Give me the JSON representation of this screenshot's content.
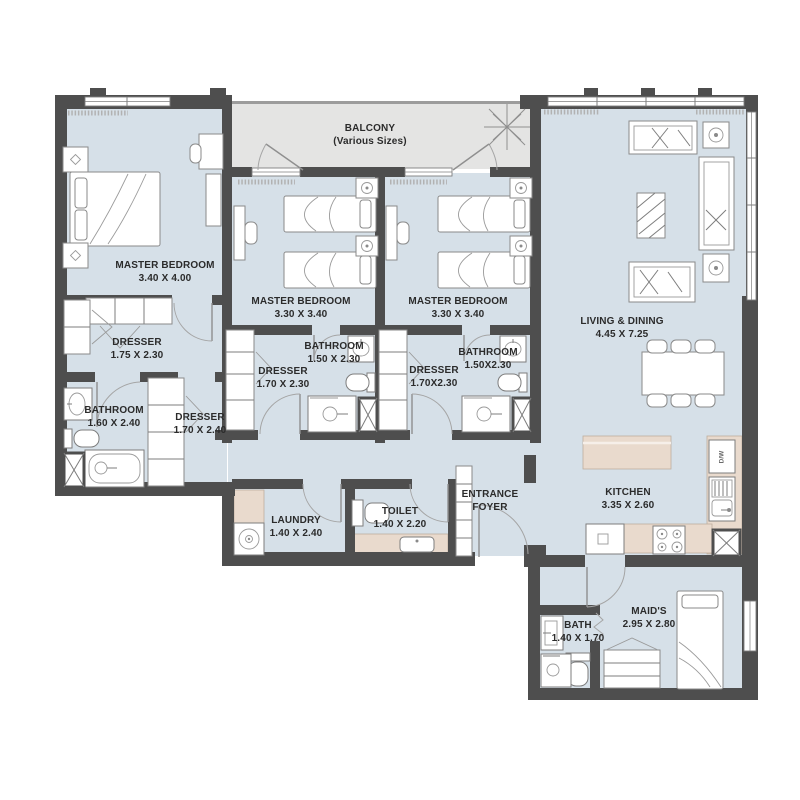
{
  "colors": {
    "wall": "#4e4e4e",
    "room_floor": "#d6e0e8",
    "balcony_floor": "#e4e4e3",
    "counter": "#e9dacd",
    "furniture_line": "#8a8a8a",
    "text": "#2b2b2b"
  },
  "rooms": [
    {
      "id": "balcony",
      "name": "BALCONY",
      "dims": "(Various Sizes)"
    },
    {
      "id": "master-bedroom-1",
      "name": "MASTER BEDROOM",
      "dims": "3.40 X 4.00"
    },
    {
      "id": "master-bedroom-2",
      "name": "MASTER BEDROOM",
      "dims": "3.30 X 3.40"
    },
    {
      "id": "master-bedroom-3",
      "name": "MASTER BEDROOM",
      "dims": "3.30 X 3.40"
    },
    {
      "id": "living-dining",
      "name": "LIVING & DINING",
      "dims": "4.45 X 7.25"
    },
    {
      "id": "dresser-1",
      "name": "DRESSER",
      "dims": "1.75 X 2.30"
    },
    {
      "id": "dresser-2",
      "name": "DRESSER",
      "dims": "1.70 X 2.30"
    },
    {
      "id": "dresser-3",
      "name": "DRESSER",
      "dims": "1.70X2.30"
    },
    {
      "id": "dresser-4",
      "name": "DRESSER",
      "dims": "1.70 X 2.40"
    },
    {
      "id": "bathroom-1",
      "name": "BATHROOM",
      "dims": "1.60 X 2.40"
    },
    {
      "id": "bathroom-2",
      "name": "BATHROOM",
      "dims": "1.50 X 2.30"
    },
    {
      "id": "bathroom-3",
      "name": "BATHROOM",
      "dims": "1.50X2.30"
    },
    {
      "id": "laundry",
      "name": "LAUNDRY",
      "dims": "1.40 X 2.40"
    },
    {
      "id": "toilet",
      "name": "TOILET",
      "dims": "1.40 X 2.20"
    },
    {
      "id": "entrance-foyer",
      "name": "ENTRANCE",
      "dims": "FOYER"
    },
    {
      "id": "kitchen",
      "name": "KITCHEN",
      "dims": "3.35 X 2.60"
    },
    {
      "id": "bath",
      "name": "BATH",
      "dims": "1.40 X 1.70"
    },
    {
      "id": "maids",
      "name": "MAID'S",
      "dims": "2.95 X 2.80"
    }
  ],
  "appliance_labels": {
    "dishwasher": "D/W"
  }
}
